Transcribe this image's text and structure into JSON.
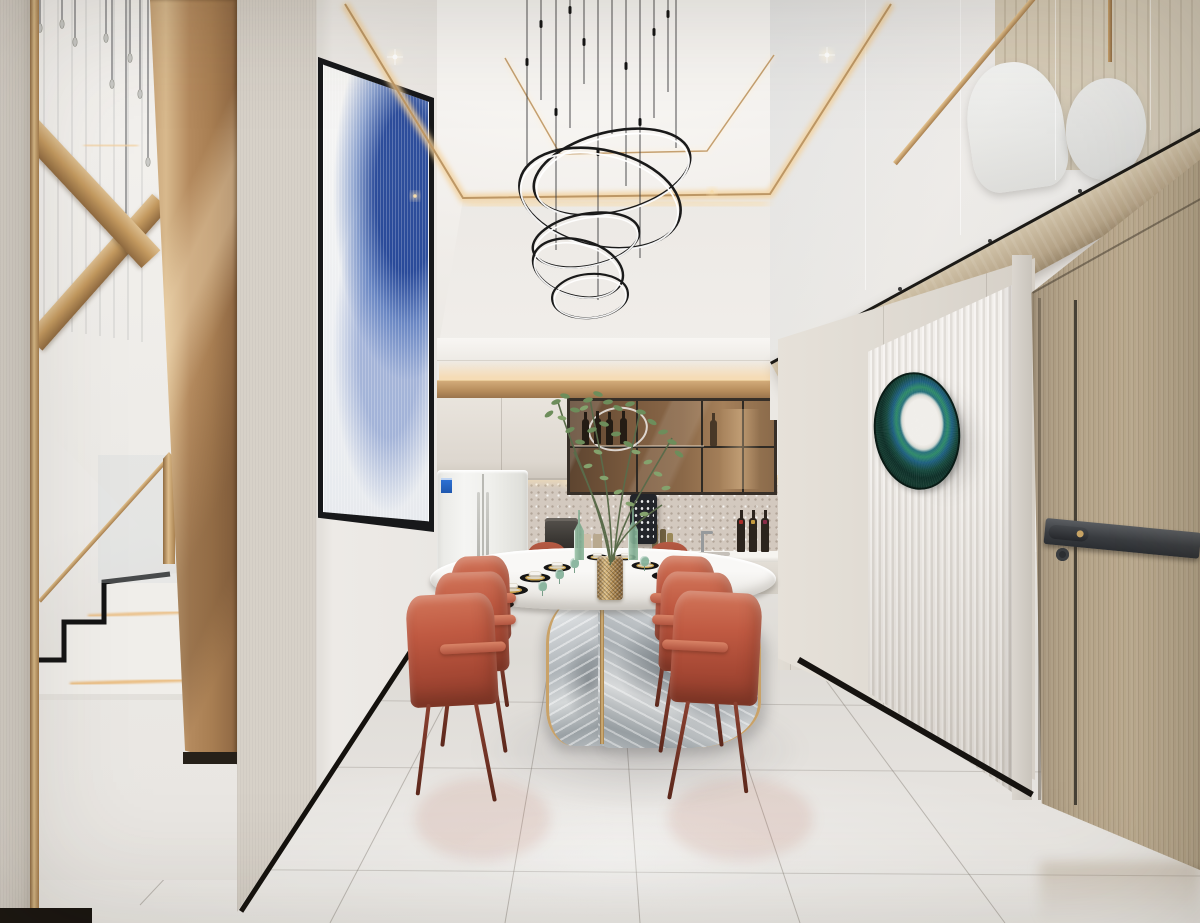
{
  "meta": {
    "kind": "photorealistic-interior-render",
    "subject": "double-height modern dining room with open kitchen, stairwell and mezzanine",
    "width_px": 1200,
    "height_px": 923,
    "visible_text": "none"
  },
  "palette": {
    "wall_greige": "#d6d0c8",
    "wall_white": "#edeae6",
    "ceiling_white": "#f4f2ef",
    "cove_glow": "#f4d9ae",
    "gold": "#c9a268",
    "gold_deep": "#8f6c44",
    "bronze_column": "#b48a5e",
    "cabinet_cream": "#e5e0d8",
    "glass_cabinet_bronze": "#8a6848",
    "backsplash_terrazzo": "#d3c9bf",
    "counter_white": "#f4f2ee",
    "fridge_white": "#efefeb",
    "fridge_screen_navy": "#141e2a",
    "fridge_screen_cyan": "#3fd0ec",
    "table_marble": "#f6f5f3",
    "table_base_grey": "#aeb4b8",
    "chair_terracotta": "#c05a42",
    "chair_terracotta_dark": "#8f3d2c",
    "plant_green": "#6d8d5b",
    "glass_green": "#7aac92",
    "mirror_teal": "#17493e",
    "mirror_blue": "#1e5f80",
    "mirror_center": "#f0eeea",
    "fluted_panel": "#ece8e3",
    "door_wood": "#b3a287",
    "door_hardware": "#3a3d41",
    "wood_band": "#b5a387",
    "floor_marble": "#e2dfda",
    "baseboard_black": "#14110d",
    "artwork_blue": "#2a4f9e",
    "chandelier_black": "#1a1a1a",
    "chandelier_led": "#ffffff"
  },
  "scene": {
    "ceiling": [
      "tray-ceiling with double gold trim",
      "warm cove lighting",
      "recessed downlights"
    ],
    "chandelier": "five nested elliptical LED rings hung on thin wires",
    "left": [
      "textured greige accent wall with gold trim strip",
      "open stairwell with glass balustrade and cable pendants",
      "gold stair stringers",
      "marble stairs with black zigzag trim and LED strips",
      "tall bronze column",
      "large framed abstract blue artwork"
    ],
    "kitchen": [
      "cream upper cabinets",
      "bronze-tinted glass display cabinet with wine bottles",
      "smart fridge with cyan screen and energy label",
      "terrazzo backsplash with under-cabinet lighting",
      "wall tablet",
      "coffee machine",
      "oil bottles",
      "three wine bottles",
      "sink and faucet",
      "recessed light-wood utility door"
    ],
    "dining": [
      "oval white marble table with curved ink-wash marble X-base and gold trim",
      "eight place settings with black chargers and gold-rim dishes",
      "green glass goblets and bottles",
      "gold mesh vase with tall green plant",
      "six terracotta leather chairs plus end chairs"
    ],
    "right": [
      "white fluted panel wall",
      "peacock-iridescence round wall mirror",
      "grey piers",
      "large light-wood door with dark grey bar handle and lock",
      "diagonal wood mezzanine band",
      "glass mezzanine balustrade with gold handrail",
      "white lounge chairs on loft",
      "wood slat wall"
    ],
    "floor": [
      "large-format glossy marble tiles",
      "radiating grout lines",
      "soft reflections of furniture"
    ]
  }
}
